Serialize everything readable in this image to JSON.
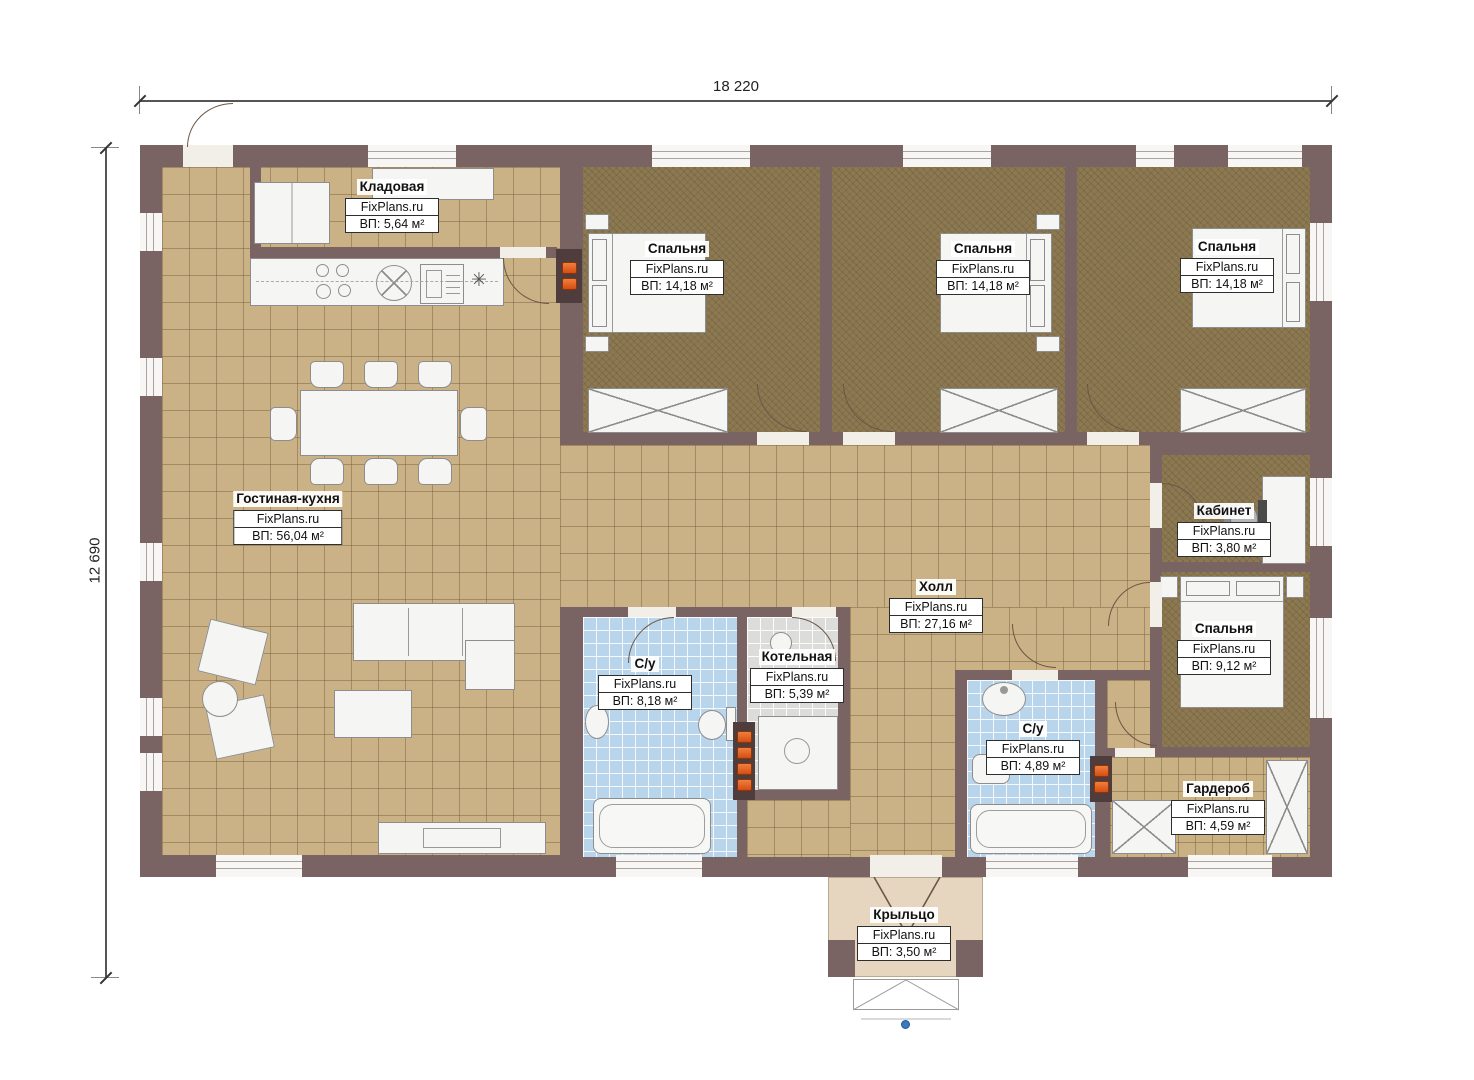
{
  "brand": "FixPlans.ru",
  "dimensions": {
    "width_label": "18 220",
    "height_label": "12 690"
  },
  "rooms": [
    {
      "name": "Кладовая",
      "area": "ВП: 5,64 м²"
    },
    {
      "name": "Спальня",
      "area": "ВП: 14,18 м²"
    },
    {
      "name": "Спальня",
      "area": "ВП: 14,18 м²"
    },
    {
      "name": "Спальня",
      "area": "ВП: 14,18 м²"
    },
    {
      "name": "Гостиная-кухня",
      "area": "ВП: 56,04 м²"
    },
    {
      "name": "Кабинет",
      "area": "ВП: 3,80 м²"
    },
    {
      "name": "Холл",
      "area": "ВП: 27,16 м²"
    },
    {
      "name": "С/у",
      "area": "ВП: 8,18 м²"
    },
    {
      "name": "Котельная",
      "area": "ВП: 5,39 м²"
    },
    {
      "name": "С/у",
      "area": "ВП: 4,89 м²"
    },
    {
      "name": "Спальня",
      "area": "ВП: 9,12 м²"
    },
    {
      "name": "Гардероб",
      "area": "ВП: 4,59 м²"
    },
    {
      "name": "Крыльцо",
      "area": "ВП: 3,50 м²"
    }
  ],
  "icons": {
    "cooktop_star": "✳"
  },
  "colors": {
    "wall": "#796363",
    "floor_tile": "#cbb286",
    "carpet": "#8c7952",
    "bath_tile": "#b9d5eb",
    "boiler_tile": "#dcdcda",
    "porch": "#e6d6c0",
    "accent_orange": "#e05c1e",
    "marker_blue": "#3a7abf"
  }
}
